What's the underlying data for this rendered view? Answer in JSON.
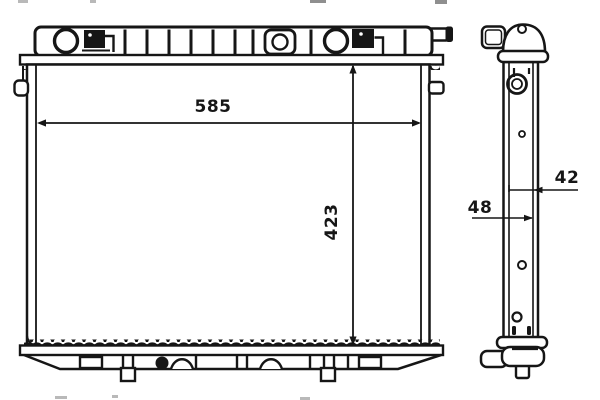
{
  "drawing": {
    "front_view": {
      "width_label": "585",
      "height_label": "423"
    },
    "side_view": {
      "core_depth_label": "42",
      "overall_depth_label": "48"
    },
    "colors": {
      "line": "#161616",
      "background": "#ffffff"
    }
  }
}
